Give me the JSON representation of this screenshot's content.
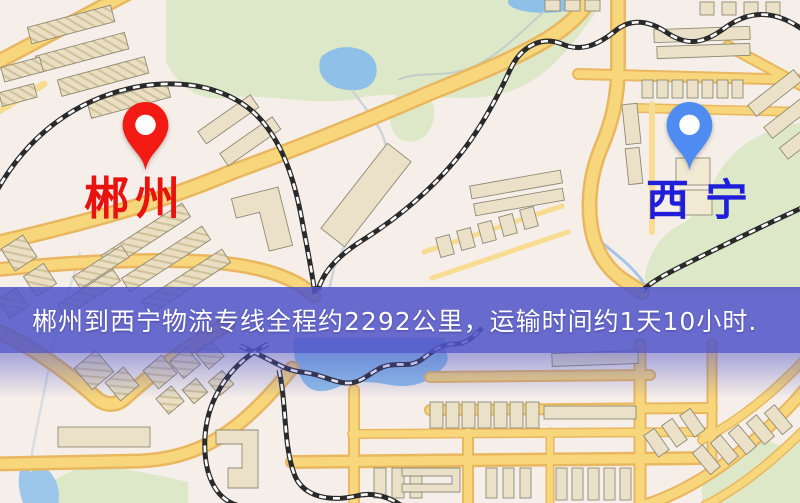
{
  "banner": {
    "text": "郴州到西宁物流专线全程约2292公里，运输时间约1天10小时.",
    "background_color": "#5054c8",
    "text_color": "#ffffff"
  },
  "route": {
    "origin": "郴州",
    "destination": "西宁",
    "distance_km": "2292",
    "duration": "1天10小时"
  },
  "markers": {
    "origin": {
      "name": "郴州",
      "pin_color": "#f21a12",
      "label_color": "#e8130e"
    },
    "destination": {
      "name": "西宁",
      "pin_color": "#4f8cf2",
      "label_color": "#1f1fd9"
    }
  },
  "map_colors": {
    "background": "#f6efe9",
    "road_fill": "#f8d77c",
    "road_casing": "#e9b75f",
    "park": "#dce8c8",
    "water": "#8fc0e8",
    "building": "#eae1c8",
    "railway": "#2a2a2a"
  }
}
